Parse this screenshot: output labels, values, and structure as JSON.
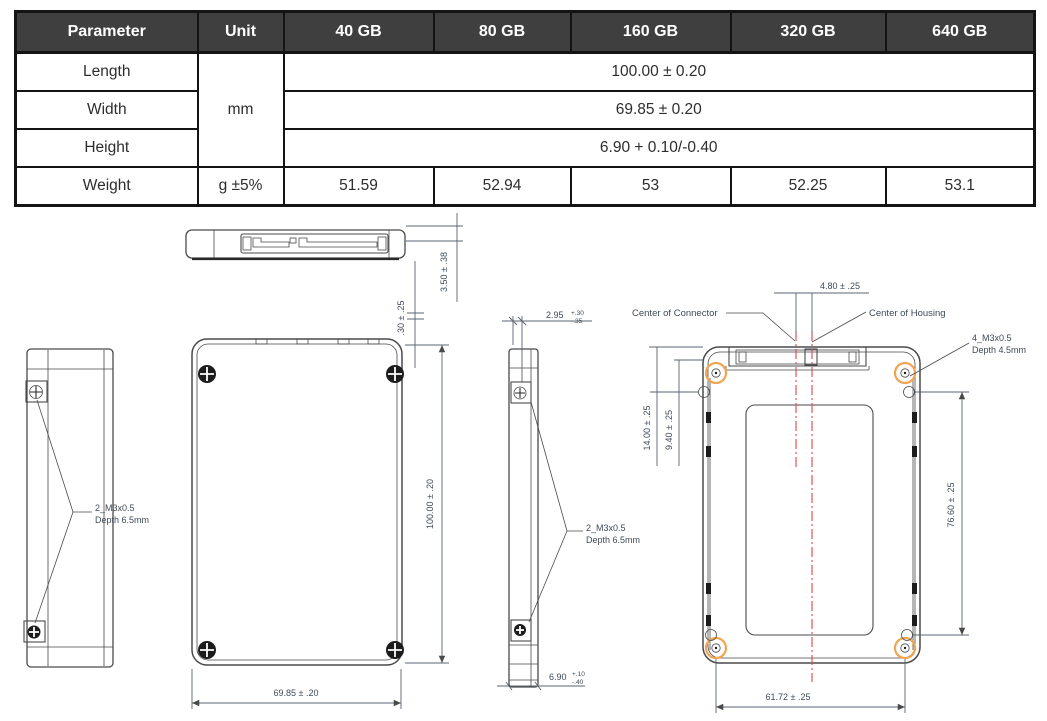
{
  "table": {
    "headers": [
      "Parameter",
      "Unit",
      "40 GB",
      "80 GB",
      "160 GB",
      "320 GB",
      "640 GB"
    ],
    "unit_mm": "mm",
    "rows": {
      "length": {
        "label": "Length",
        "value": "100.00 ± 0.20"
      },
      "width": {
        "label": "Width",
        "value": "69.85 ± 0.20"
      },
      "height": {
        "label": "Height",
        "value": "6.90 + 0.10/-0.40"
      },
      "weight": {
        "label": "Weight",
        "unit": "g ±5%",
        "values": [
          "51.59",
          "52.94",
          "53",
          "52.25",
          "53.1"
        ]
      }
    }
  },
  "drawing": {
    "top_edge_view": {
      "dim_connector_height": "3.50 ± .38",
      "dim_cover_gap": ".30 ± .25"
    },
    "left_side_view": {
      "screw_note_line1": "2_M3x0.5",
      "screw_note_line2": "Depth 6.5mm"
    },
    "front_view": {
      "dim_length": "100.00 ± .20",
      "dim_width": "69.85 ± .20"
    },
    "right_side_view": {
      "dim_hole_offset_value": "2.95",
      "dim_hole_offset_tol_plus": "+.30",
      "dim_hole_offset_tol_minus": "-.35",
      "screw_note_line1": "2_M3x0.5",
      "screw_note_line2": "Depth 6.5mm",
      "dim_height_value": "6.90",
      "dim_height_tol_plus": "+.10",
      "dim_height_tol_minus": "-.40"
    },
    "bottom_view": {
      "dim_connector_offset": "4.80 ± .25",
      "label_center_of_connector": "Center of Connector",
      "label_center_of_housing": "Center of Housing",
      "screw_note_line1": "4_M3x0.5",
      "screw_note_line2": "Depth 4.5mm",
      "dim_hole_to_top": "14.00 ± .25",
      "dim_hole_to_edge": "9.40 ± .25",
      "dim_hole_span_vertical": "76.60 ± .25",
      "dim_hole_span_horizontal": "61.72 ± .25"
    },
    "colors": {
      "line": "#4a4a4a",
      "dim_text": "#3e4a58",
      "centerline": "#e04545",
      "hole_highlight": "#f0a552",
      "table_header_bg": "#3f3f3f"
    }
  }
}
